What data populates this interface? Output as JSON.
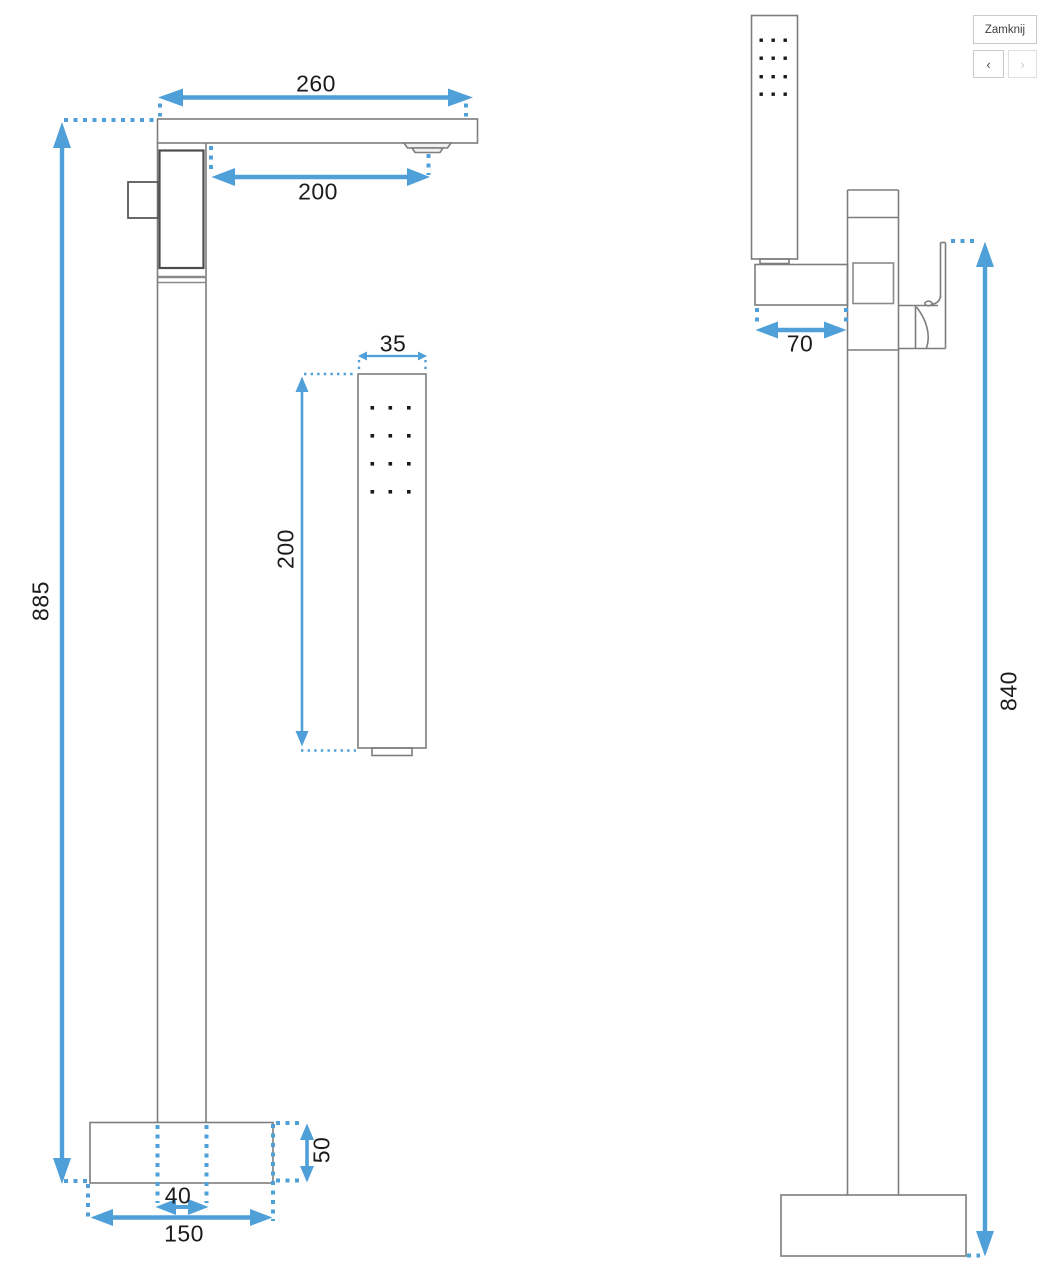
{
  "viewer": {
    "close_button_label": "Zamknij",
    "prev_button_glyph": "‹",
    "next_button_glyph": "›"
  },
  "front_view": {
    "spout_width": "260",
    "spout_reach": "200",
    "total_height": "885",
    "column_width": "40",
    "base_width": "150",
    "base_height": "50"
  },
  "hand_shower": {
    "width": "35",
    "length": "200"
  },
  "side_view": {
    "bracket_depth": "70",
    "height_to_handle": "840"
  },
  "colors": {
    "dimension_blue": "#4f9fd8",
    "outline_gray": "#7d7d7d"
  }
}
